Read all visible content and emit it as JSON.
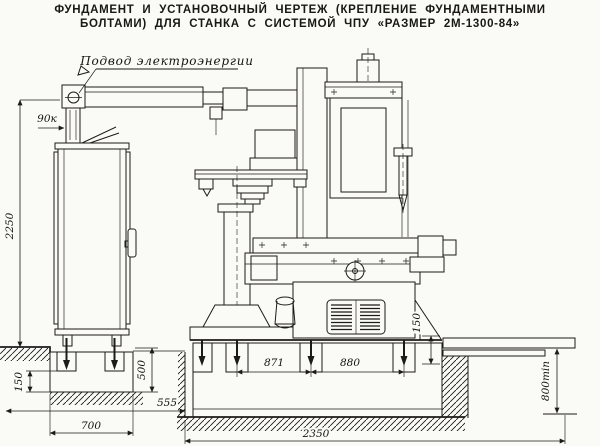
{
  "title": {
    "line1": "ФУНДАМЕНТ И УСТАНОВОЧНЫЙ ЧЕРТЕЖ (КРЕПЛЕНИЕ ФУНДАМЕНТНЫМИ",
    "line2": "БОЛТАМИ) ДЛЯ СТАНКА С СИСТЕМОЙ ЧПУ «РАЗМЕР 2М-1300-84»"
  },
  "labels": {
    "power_supply": "Подвод электроэнергии"
  },
  "dims": {
    "overall_height": "2250",
    "power_offset": "90к",
    "left_pocket_depth": "150",
    "left_block_depth": "500",
    "block_gap": "555",
    "left_block_width": "700",
    "bolt_span_left": "871",
    "bolt_span_right": "880",
    "main_block_length": "2350",
    "right_recess_depth": "150",
    "trench_depth": "800min"
  },
  "colors": {
    "paper": "#fafaf6",
    "ink": "#1c1b18"
  }
}
